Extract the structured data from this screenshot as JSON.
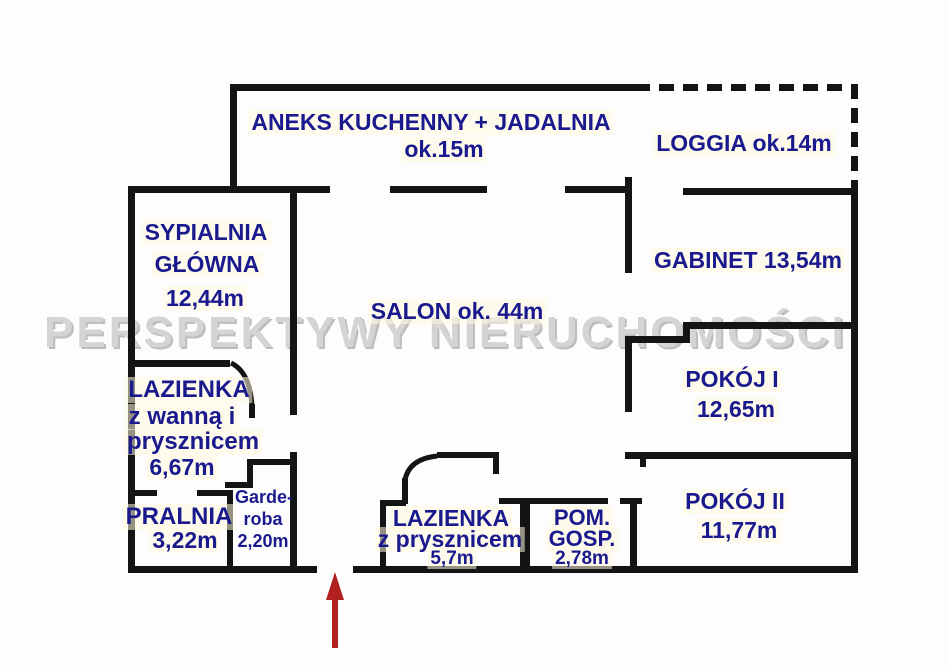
{
  "watermark": "PERSPEKTYWY NIERUCHOMOŚCI",
  "colors": {
    "wall": "#141414",
    "label": "#1a1a8e",
    "watermark_gray": "#d4d4d4",
    "arrow_red": "#b32020",
    "background": "#fdfdfd"
  },
  "rooms": {
    "aneks": {
      "line1": "ANEKS KUCHENNY + JADALNIA",
      "line2": "ok.15m"
    },
    "loggia": {
      "line1": "LOGGIA ok.14m"
    },
    "sypialnia": {
      "line1": "SYPIALNIA",
      "line2": "GŁÓWNA",
      "line3": "12,44m"
    },
    "salon": {
      "line1": "SALON ok. 44m"
    },
    "gabinet": {
      "line1": "GABINET 13,54m"
    },
    "pokoj1": {
      "line1": "POKÓJ I",
      "line2": "12,65m"
    },
    "pokoj2": {
      "line1": "POKÓJ II",
      "line2": "11,77m"
    },
    "lazienka1": {
      "line1": "LAZIENKA",
      "line2": "z wanną i",
      "line3": "prysznicem",
      "line4": "6,67m"
    },
    "pralnia": {
      "line1": "PRALNIA",
      "line2": "3,22m"
    },
    "garderoba": {
      "line1": "Garde-",
      "line2": "roba",
      "line3": "2,20m"
    },
    "lazienka2": {
      "line1": "LAZIENKA",
      "line2": "z prysznicem",
      "line3": "5,7m"
    },
    "pomgosp": {
      "line1": "POM.",
      "line2": "GOSP.",
      "line3": "2,78m"
    }
  }
}
